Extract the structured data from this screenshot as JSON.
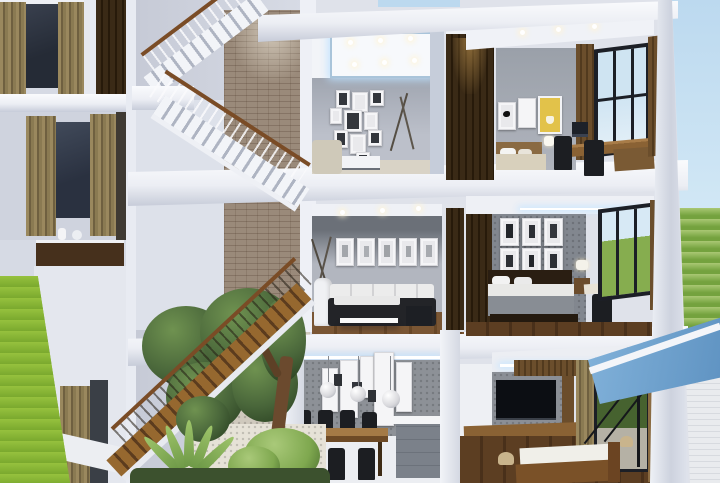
{
  "scene": {
    "kind": "3D architectural cutaway rendering",
    "subject": "Three-storey modern townhouse cross-section with open stairwell",
    "exterior": [
      "pale-blue-sky",
      "green-lawn-left",
      "green-hillside-right",
      "blue-glass-canopy",
      "white-siding-wall"
    ],
    "floors": [
      {
        "level": "third",
        "rooms": [
          "stair-hall-with-brick-feature-wall",
          "gallery-lounge-with-led-tray-ceiling",
          "study-bedroom-with-desk-and-window"
        ]
      },
      {
        "level": "second",
        "rooms": [
          "stair-landing",
          "living-room-with-five-framed-prints",
          "bedroom-with-six-poster-grid"
        ]
      },
      {
        "level": "first",
        "rooms": [
          "indoor-garden-under-stairs",
          "dining-room-with-kitchen-island",
          "tv-bedroom-with-terrace-door"
        ]
      }
    ],
    "notable_objects": [
      "floating-staircase",
      "wood-handrail",
      "photo-gallery-wall",
      "olive-curtains",
      "beige-armchair",
      "black-white-sofa",
      "white-coffee-table",
      "tall-white-vase",
      "dining-table",
      "black-dining-chairs",
      "globe-pendant-lamps",
      "kitchen-island",
      "double-bed",
      "nightstand-lamp",
      "desk-with-monitor",
      "office-chairs",
      "yellow-poster",
      "bird-poster",
      "animal-poster-grid",
      "wall-mounted-tv",
      "floating-wood-console",
      "indoor-tree",
      "agave-plant",
      "pebble-floor",
      "wood-slat-screens"
    ]
  },
  "palette": {
    "sky1": "#bcd9ef",
    "sky2": "#def0f9",
    "lawn1": "#96c13e",
    "lawn2": "#7aa92e",
    "hill1": "#a9c873",
    "hill2": "#74a23e",
    "canopy1": "#82b2da",
    "canopy2": "#5f93c2",
    "slabHi": "#fafbfd",
    "slab": "#eceef4",
    "slabLo": "#c7ccd9",
    "wallLight": "#d6dae4",
    "wallGray": "#9298a2",
    "wallDark": "#6b7078",
    "concrete": "#8d9197",
    "brick": "#9a8a7a",
    "pebble": "#cfc9bd",
    "woodDark": "#3a2a16",
    "woodMid": "#6b4e2c",
    "woodFloor": "#7a5634",
    "woodWarm": "#8a6234",
    "railWood": "#7a4c26",
    "curtain": "#8a7a52",
    "frameYellow": "#e2c24a",
    "tv": "#0c0e13",
    "foliage1": "#6f9250",
    "foliage2": "#324a28",
    "siding": "#e9ebee",
    "white": "#f2f4f8"
  }
}
